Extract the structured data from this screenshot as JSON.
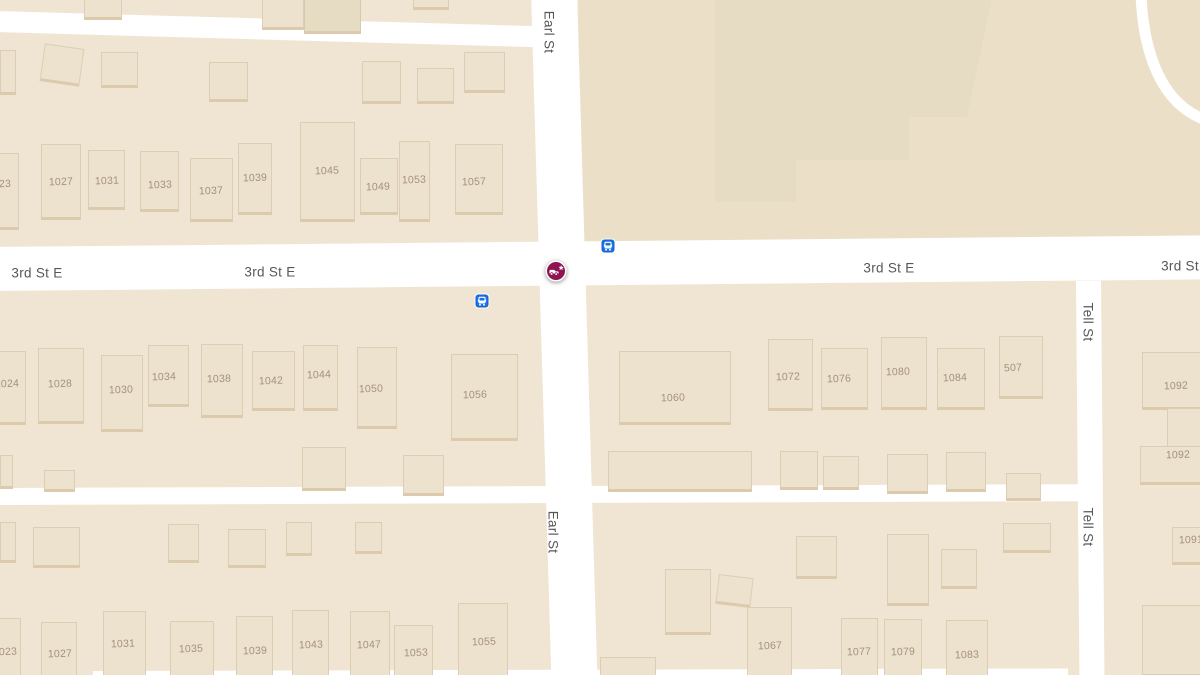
{
  "app": {
    "type": "map-view",
    "description": "street map of Earl St / 3rd St E intersection with incident marker"
  },
  "colors": {
    "land": "#F0E5D3",
    "block_shade_ne": "#EBDFC8",
    "road": "#FFFFFF",
    "building_fill": "#ECE2CE",
    "building_fill_dark": "#E6DBC3",
    "building_edge": "#DCCAAC",
    "building_outline": "rgba(203,183,148,0.45)",
    "large_building_fill": "#E6DBC3",
    "street_text": "#575757",
    "number_text": "#A5917A",
    "bus_fill": "#1A73E8",
    "bus_stroke": "#1A5FC8",
    "crash_fill": "#8E1452",
    "crash_ring": "#FFFFFF"
  },
  "map": {
    "width": 1200,
    "height": 675,
    "street_labels": [
      {
        "text": "Earl St",
        "x": 549,
        "y": 32,
        "vertical": true
      },
      {
        "text": "Earl St",
        "x": 553,
        "y": 532,
        "vertical": true
      },
      {
        "text": "Tell St",
        "x": 1088,
        "y": 322,
        "vertical": true
      },
      {
        "text": "Tell St",
        "x": 1088,
        "y": 527,
        "vertical": true
      },
      {
        "text": "3rd St E",
        "x": 37,
        "y": 273,
        "vertical": false
      },
      {
        "text": "3rd St E",
        "x": 270,
        "y": 272,
        "vertical": false
      },
      {
        "text": "3rd St E",
        "x": 889,
        "y": 268,
        "vertical": false
      },
      {
        "text": "3rd St",
        "x": 1180,
        "y": 266,
        "vertical": false
      }
    ],
    "roads": [
      {
        "id": "3rd-st-e",
        "x": -8,
        "y": 247,
        "w": 1216,
        "h": 44,
        "rot": -0.55
      },
      {
        "id": "earl-st",
        "x": 531,
        "y": -8,
        "w": 46,
        "h": 692,
        "rot": -1.7
      },
      {
        "id": "tell-st",
        "x": 1076,
        "y": 281,
        "w": 25,
        "h": 400,
        "rot": -0.5
      },
      {
        "id": "alley-north",
        "x": -6,
        "y": 11,
        "w": 556,
        "h": 21,
        "rot": 1.6
      },
      {
        "id": "alley-mid",
        "x": -6,
        "y": 488,
        "w": 1090,
        "h": 17,
        "rot": -0.2
      },
      {
        "id": "alley-south",
        "x": 93,
        "y": 671,
        "w": 975,
        "h": 12,
        "rot": -0.15
      }
    ],
    "block_shades": [
      {
        "id": "block-north-east",
        "x": 578,
        "y": -8,
        "w": 630,
        "h": 250,
        "rot": -0.5
      }
    ],
    "large_building": {
      "x": 715,
      "y": -2,
      "w": 277,
      "h": 206,
      "clip": "polygon(0px 0px, 277px 0px, 252px 119px, 194px 119px, 194px 162px, 81px 162px, 81px 204px, 0px 204px)"
    },
    "curved_road_path": "M1141,-6 C1143,50 1160,104 1206,120",
    "buildings": [
      {
        "x": 84,
        "y": -8,
        "w": 38,
        "h": 28
      },
      {
        "x": 262,
        "y": -10,
        "w": 42,
        "h": 40
      },
      {
        "x": 304,
        "y": -14,
        "w": 57,
        "h": 48,
        "tone": "dark"
      },
      {
        "x": 413,
        "y": -8,
        "w": 36,
        "h": 18
      },
      {
        "x": 0,
        "y": 50,
        "w": 16,
        "h": 45
      },
      {
        "x": 42,
        "y": 46,
        "w": 40,
        "h": 38,
        "rot": 8
      },
      {
        "x": 101,
        "y": 52,
        "w": 37,
        "h": 36
      },
      {
        "x": 209,
        "y": 62,
        "w": 39,
        "h": 40
      },
      {
        "x": 362,
        "y": 61,
        "w": 39,
        "h": 43
      },
      {
        "x": 417,
        "y": 68,
        "w": 37,
        "h": 36
      },
      {
        "x": 464,
        "y": 52,
        "w": 41,
        "h": 41
      },
      {
        "n": "23",
        "x": -14,
        "y": 153,
        "w": 33,
        "h": 77,
        "lx": 5,
        "ly": 184
      },
      {
        "n": "1027",
        "x": 41,
        "y": 144,
        "w": 40,
        "h": 76,
        "lx": 61,
        "ly": 182
      },
      {
        "n": "1031",
        "x": 88,
        "y": 150,
        "w": 37,
        "h": 60,
        "lx": 107,
        "ly": 181
      },
      {
        "n": "1033",
        "x": 140,
        "y": 151,
        "w": 39,
        "h": 61,
        "lx": 160,
        "ly": 185
      },
      {
        "n": "1037",
        "x": 190,
        "y": 158,
        "w": 43,
        "h": 64,
        "lx": 211,
        "ly": 191
      },
      {
        "n": "1039",
        "x": 238,
        "y": 143,
        "w": 34,
        "h": 72,
        "lx": 255,
        "ly": 178
      },
      {
        "n": "1045",
        "x": 300,
        "y": 122,
        "w": 55,
        "h": 100,
        "lx": 327,
        "ly": 171
      },
      {
        "n": "1049",
        "x": 360,
        "y": 158,
        "w": 38,
        "h": 57,
        "lx": 378,
        "ly": 187
      },
      {
        "n": "1053",
        "x": 399,
        "y": 141,
        "w": 31,
        "h": 81,
        "lx": 414,
        "ly": 180
      },
      {
        "n": "1057",
        "x": 455,
        "y": 144,
        "w": 48,
        "h": 71,
        "lx": 474,
        "ly": 182
      },
      {
        "n": "1024",
        "x": -14,
        "y": 351,
        "w": 40,
        "h": 74,
        "lx": 7,
        "ly": 384
      },
      {
        "n": "1028",
        "x": 38,
        "y": 348,
        "w": 46,
        "h": 76,
        "lx": 60,
        "ly": 384
      },
      {
        "n": "1030",
        "x": 101,
        "y": 355,
        "w": 42,
        "h": 77,
        "lx": 121,
        "ly": 390
      },
      {
        "n": "1034",
        "x": 148,
        "y": 345,
        "w": 41,
        "h": 62,
        "lx": 164,
        "ly": 377
      },
      {
        "n": "1038",
        "x": 201,
        "y": 344,
        "w": 42,
        "h": 74,
        "lx": 219,
        "ly": 379
      },
      {
        "n": "1042",
        "x": 252,
        "y": 351,
        "w": 43,
        "h": 60,
        "lx": 271,
        "ly": 381
      },
      {
        "n": "1044",
        "x": 303,
        "y": 345,
        "w": 35,
        "h": 66,
        "lx": 319,
        "ly": 375
      },
      {
        "n": "1050",
        "x": 357,
        "y": 347,
        "w": 40,
        "h": 82,
        "lx": 371,
        "ly": 389
      },
      {
        "n": "1056",
        "x": 451,
        "y": 354,
        "w": 67,
        "h": 87,
        "lx": 475,
        "ly": 395
      },
      {
        "x": 0,
        "y": 455,
        "w": 13,
        "h": 34
      },
      {
        "x": 44,
        "y": 470,
        "w": 31,
        "h": 22
      },
      {
        "x": 302,
        "y": 447,
        "w": 44,
        "h": 44
      },
      {
        "x": 403,
        "y": 455,
        "w": 41,
        "h": 41
      },
      {
        "n": "1060",
        "x": 619,
        "y": 351,
        "w": 112,
        "h": 74,
        "lx": 673,
        "ly": 398
      },
      {
        "n": "1072",
        "x": 768,
        "y": 339,
        "w": 45,
        "h": 72,
        "lx": 788,
        "ly": 377
      },
      {
        "n": "1076",
        "x": 821,
        "y": 348,
        "w": 47,
        "h": 62,
        "lx": 839,
        "ly": 379
      },
      {
        "n": "1080",
        "x": 881,
        "y": 337,
        "w": 46,
        "h": 73,
        "lx": 898,
        "ly": 372
      },
      {
        "n": "1084",
        "x": 937,
        "y": 348,
        "w": 48,
        "h": 62,
        "lx": 955,
        "ly": 378
      },
      {
        "n": "507",
        "x": 999,
        "y": 336,
        "w": 44,
        "h": 63,
        "lx": 1013,
        "ly": 368
      },
      {
        "x": 608,
        "y": 451,
        "w": 144,
        "h": 41
      },
      {
        "x": 780,
        "y": 451,
        "w": 38,
        "h": 39
      },
      {
        "x": 823,
        "y": 456,
        "w": 36,
        "h": 34
      },
      {
        "x": 887,
        "y": 454,
        "w": 41,
        "h": 40
      },
      {
        "x": 946,
        "y": 452,
        "w": 40,
        "h": 40
      },
      {
        "x": 1006,
        "y": 473,
        "w": 35,
        "h": 28
      },
      {
        "n": "1092",
        "x": 1142,
        "y": 352,
        "w": 60,
        "h": 58,
        "lx": 1176,
        "ly": 386
      },
      {
        "x": 1167,
        "y": 408,
        "w": 35,
        "h": 42
      },
      {
        "n": "1092",
        "x": 1140,
        "y": 446,
        "w": 62,
        "h": 39,
        "lx": 1178,
        "ly": 455
      },
      {
        "n": "1091",
        "x": 1172,
        "y": 527,
        "w": 30,
        "h": 38,
        "lx": 1191,
        "ly": 540
      },
      {
        "x": 1142,
        "y": 605,
        "w": 60,
        "h": 72
      },
      {
        "x": 0,
        "y": 522,
        "w": 16,
        "h": 41
      },
      {
        "x": 33,
        "y": 527,
        "w": 47,
        "h": 41
      },
      {
        "x": 168,
        "y": 524,
        "w": 31,
        "h": 39
      },
      {
        "x": 228,
        "y": 529,
        "w": 38,
        "h": 39
      },
      {
        "x": 286,
        "y": 522,
        "w": 26,
        "h": 34
      },
      {
        "x": 355,
        "y": 522,
        "w": 27,
        "h": 32
      },
      {
        "n": "1023",
        "x": -12,
        "y": 618,
        "w": 33,
        "h": 60,
        "lx": 5,
        "ly": 652
      },
      {
        "n": "1027",
        "x": 41,
        "y": 622,
        "w": 36,
        "h": 56,
        "lx": 60,
        "ly": 654
      },
      {
        "n": "1031",
        "x": 103,
        "y": 611,
        "w": 43,
        "h": 67,
        "lx": 123,
        "ly": 644
      },
      {
        "n": "1035",
        "x": 170,
        "y": 621,
        "w": 44,
        "h": 57,
        "lx": 191,
        "ly": 649
      },
      {
        "n": "1039",
        "x": 236,
        "y": 616,
        "w": 37,
        "h": 62,
        "lx": 255,
        "ly": 651
      },
      {
        "n": "1043",
        "x": 292,
        "y": 610,
        "w": 37,
        "h": 68,
        "lx": 311,
        "ly": 645
      },
      {
        "n": "1047",
        "x": 350,
        "y": 611,
        "w": 40,
        "h": 67,
        "lx": 369,
        "ly": 645
      },
      {
        "n": "1053",
        "x": 394,
        "y": 625,
        "w": 39,
        "h": 53,
        "lx": 416,
        "ly": 653
      },
      {
        "n": "1055",
        "x": 458,
        "y": 603,
        "w": 50,
        "h": 75,
        "lx": 484,
        "ly": 642
      },
      {
        "x": 665,
        "y": 569,
        "w": 46,
        "h": 66
      },
      {
        "x": 717,
        "y": 576,
        "w": 35,
        "h": 30,
        "rot": 7
      },
      {
        "x": 796,
        "y": 536,
        "w": 41,
        "h": 43
      },
      {
        "x": 887,
        "y": 534,
        "w": 42,
        "h": 72
      },
      {
        "x": 941,
        "y": 549,
        "w": 36,
        "h": 40
      },
      {
        "x": 1003,
        "y": 523,
        "w": 48,
        "h": 30
      },
      {
        "x": 600,
        "y": 657,
        "w": 56,
        "h": 21
      },
      {
        "n": "1067",
        "x": 747,
        "y": 607,
        "w": 45,
        "h": 71,
        "lx": 770,
        "ly": 646
      },
      {
        "n": "1077",
        "x": 841,
        "y": 618,
        "w": 37,
        "h": 60,
        "lx": 859,
        "ly": 652
      },
      {
        "n": "1079",
        "x": 884,
        "y": 619,
        "w": 38,
        "h": 59,
        "lx": 903,
        "ly": 652
      },
      {
        "n": "1083",
        "x": 946,
        "y": 620,
        "w": 42,
        "h": 58,
        "lx": 967,
        "ly": 655
      }
    ],
    "bus_stops": [
      {
        "x": 608,
        "y": 246
      },
      {
        "x": 482,
        "y": 301
      }
    ],
    "incident": {
      "type": "crash",
      "x": 556,
      "y": 271
    }
  }
}
